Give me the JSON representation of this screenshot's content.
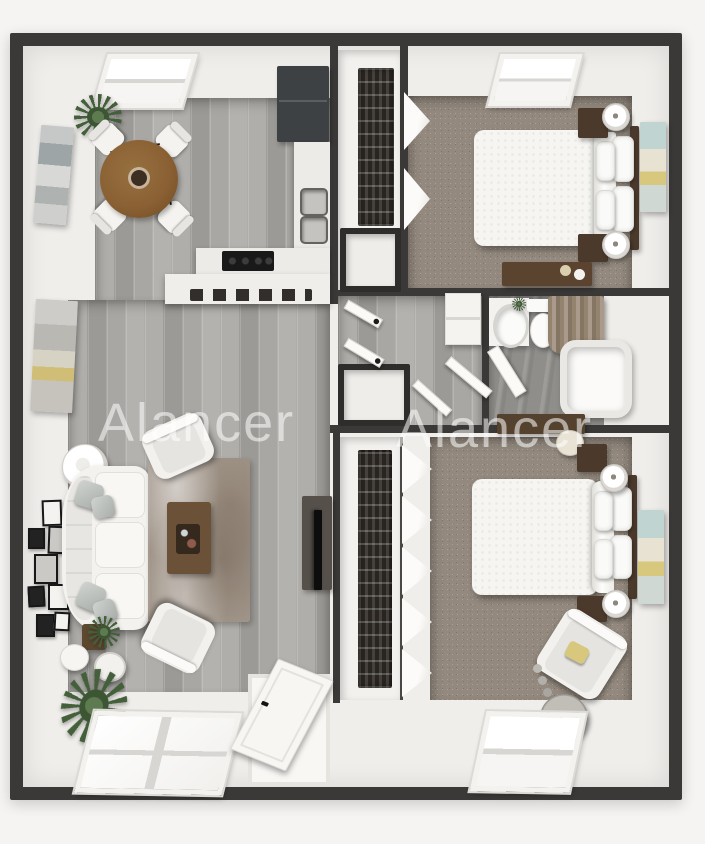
{
  "watermarks": [
    {
      "text": "Alancer"
    },
    {
      "text": "Alancer"
    }
  ],
  "colors": {
    "background": "#f6f4f2",
    "wall": "#3b3937",
    "wall_face": "#f0eeeb",
    "wood_floor": "#a7a5a1",
    "bedroom_carpet": "#93897e",
    "bathroom_floor": "#8f8e8b",
    "kitchen_cabinet": "#3e4144",
    "counter": "#edebe7",
    "dining_table_wood": "#8b6134",
    "dark_wood_furniture": "#4b3a2c",
    "tv_console": "#55504a",
    "art_accent_teal": "#c0d5d1",
    "art_accent_yellow": "#d8c87d",
    "plant_green": "#44603b",
    "shower_curtain_taupe": "#93836f",
    "watermark_white": "rgba(255,255,255,0.55)"
  }
}
